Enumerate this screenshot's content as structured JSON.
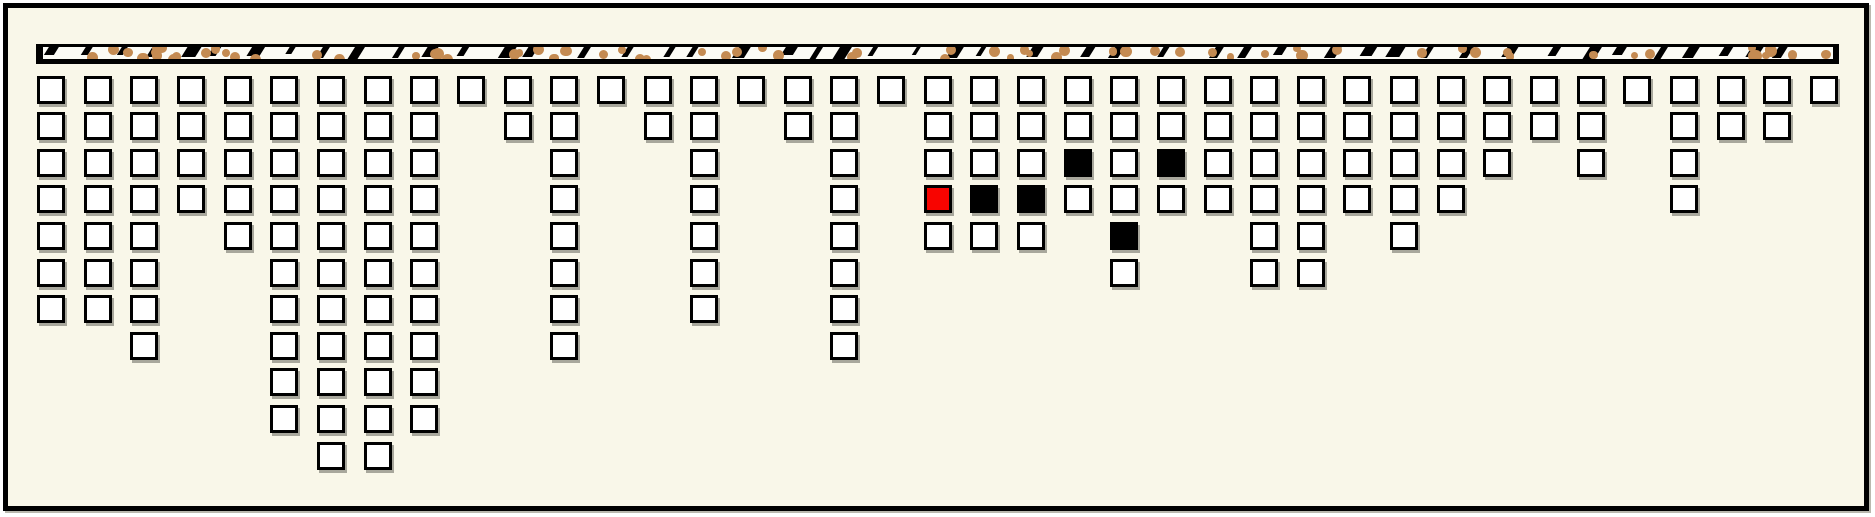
{
  "scene": {
    "background_color": "#F9F7E9",
    "frame_color": "#000000",
    "beam": {
      "fill_color": "#FBFBF5",
      "border_color": "#000000",
      "dot_color": "#C48B52",
      "tick_color": "#000000",
      "dot_count": 74,
      "tick_count": 46
    },
    "cell_colors": {
      "empty_fill": "#FFFFFF",
      "black_fill": "#000000",
      "red_fill": "#F80400",
      "border": "#000000",
      "shadow": "#A8A79C"
    }
  },
  "chart_data": {
    "type": "bar",
    "orientation": "hanging-from-top",
    "unit": "squares",
    "title": "",
    "xlabel": "",
    "ylabel": "",
    "grid": "off",
    "legend": "none",
    "ylim": [
      0,
      11
    ],
    "categories": [
      1,
      2,
      3,
      4,
      5,
      6,
      7,
      8,
      9,
      10,
      11,
      12,
      13,
      14,
      15,
      16,
      17,
      18,
      19,
      20,
      21,
      22,
      23,
      24,
      25,
      26,
      27,
      28,
      29,
      30,
      31,
      32,
      33,
      34,
      35,
      36,
      37,
      38,
      39
    ],
    "values": [
      7,
      7,
      8,
      4,
      5,
      10,
      11,
      11,
      10,
      1,
      2,
      8,
      1,
      2,
      7,
      1,
      2,
      8,
      1,
      5,
      5,
      5,
      4,
      6,
      4,
      4,
      6,
      6,
      4,
      5,
      4,
      3,
      2,
      3,
      1,
      4,
      2,
      2,
      1
    ],
    "marked_cells": [
      {
        "column": 20,
        "row": 4,
        "color": "red"
      },
      {
        "column": 21,
        "row": 4,
        "color": "black"
      },
      {
        "column": 22,
        "row": 4,
        "color": "black"
      },
      {
        "column": 23,
        "row": 3,
        "color": "black"
      },
      {
        "column": 24,
        "row": 5,
        "color": "black"
      },
      {
        "column": 25,
        "row": 3,
        "color": "black"
      }
    ],
    "total_squares": 163,
    "black_square_count": 5,
    "red_square_count": 1
  }
}
